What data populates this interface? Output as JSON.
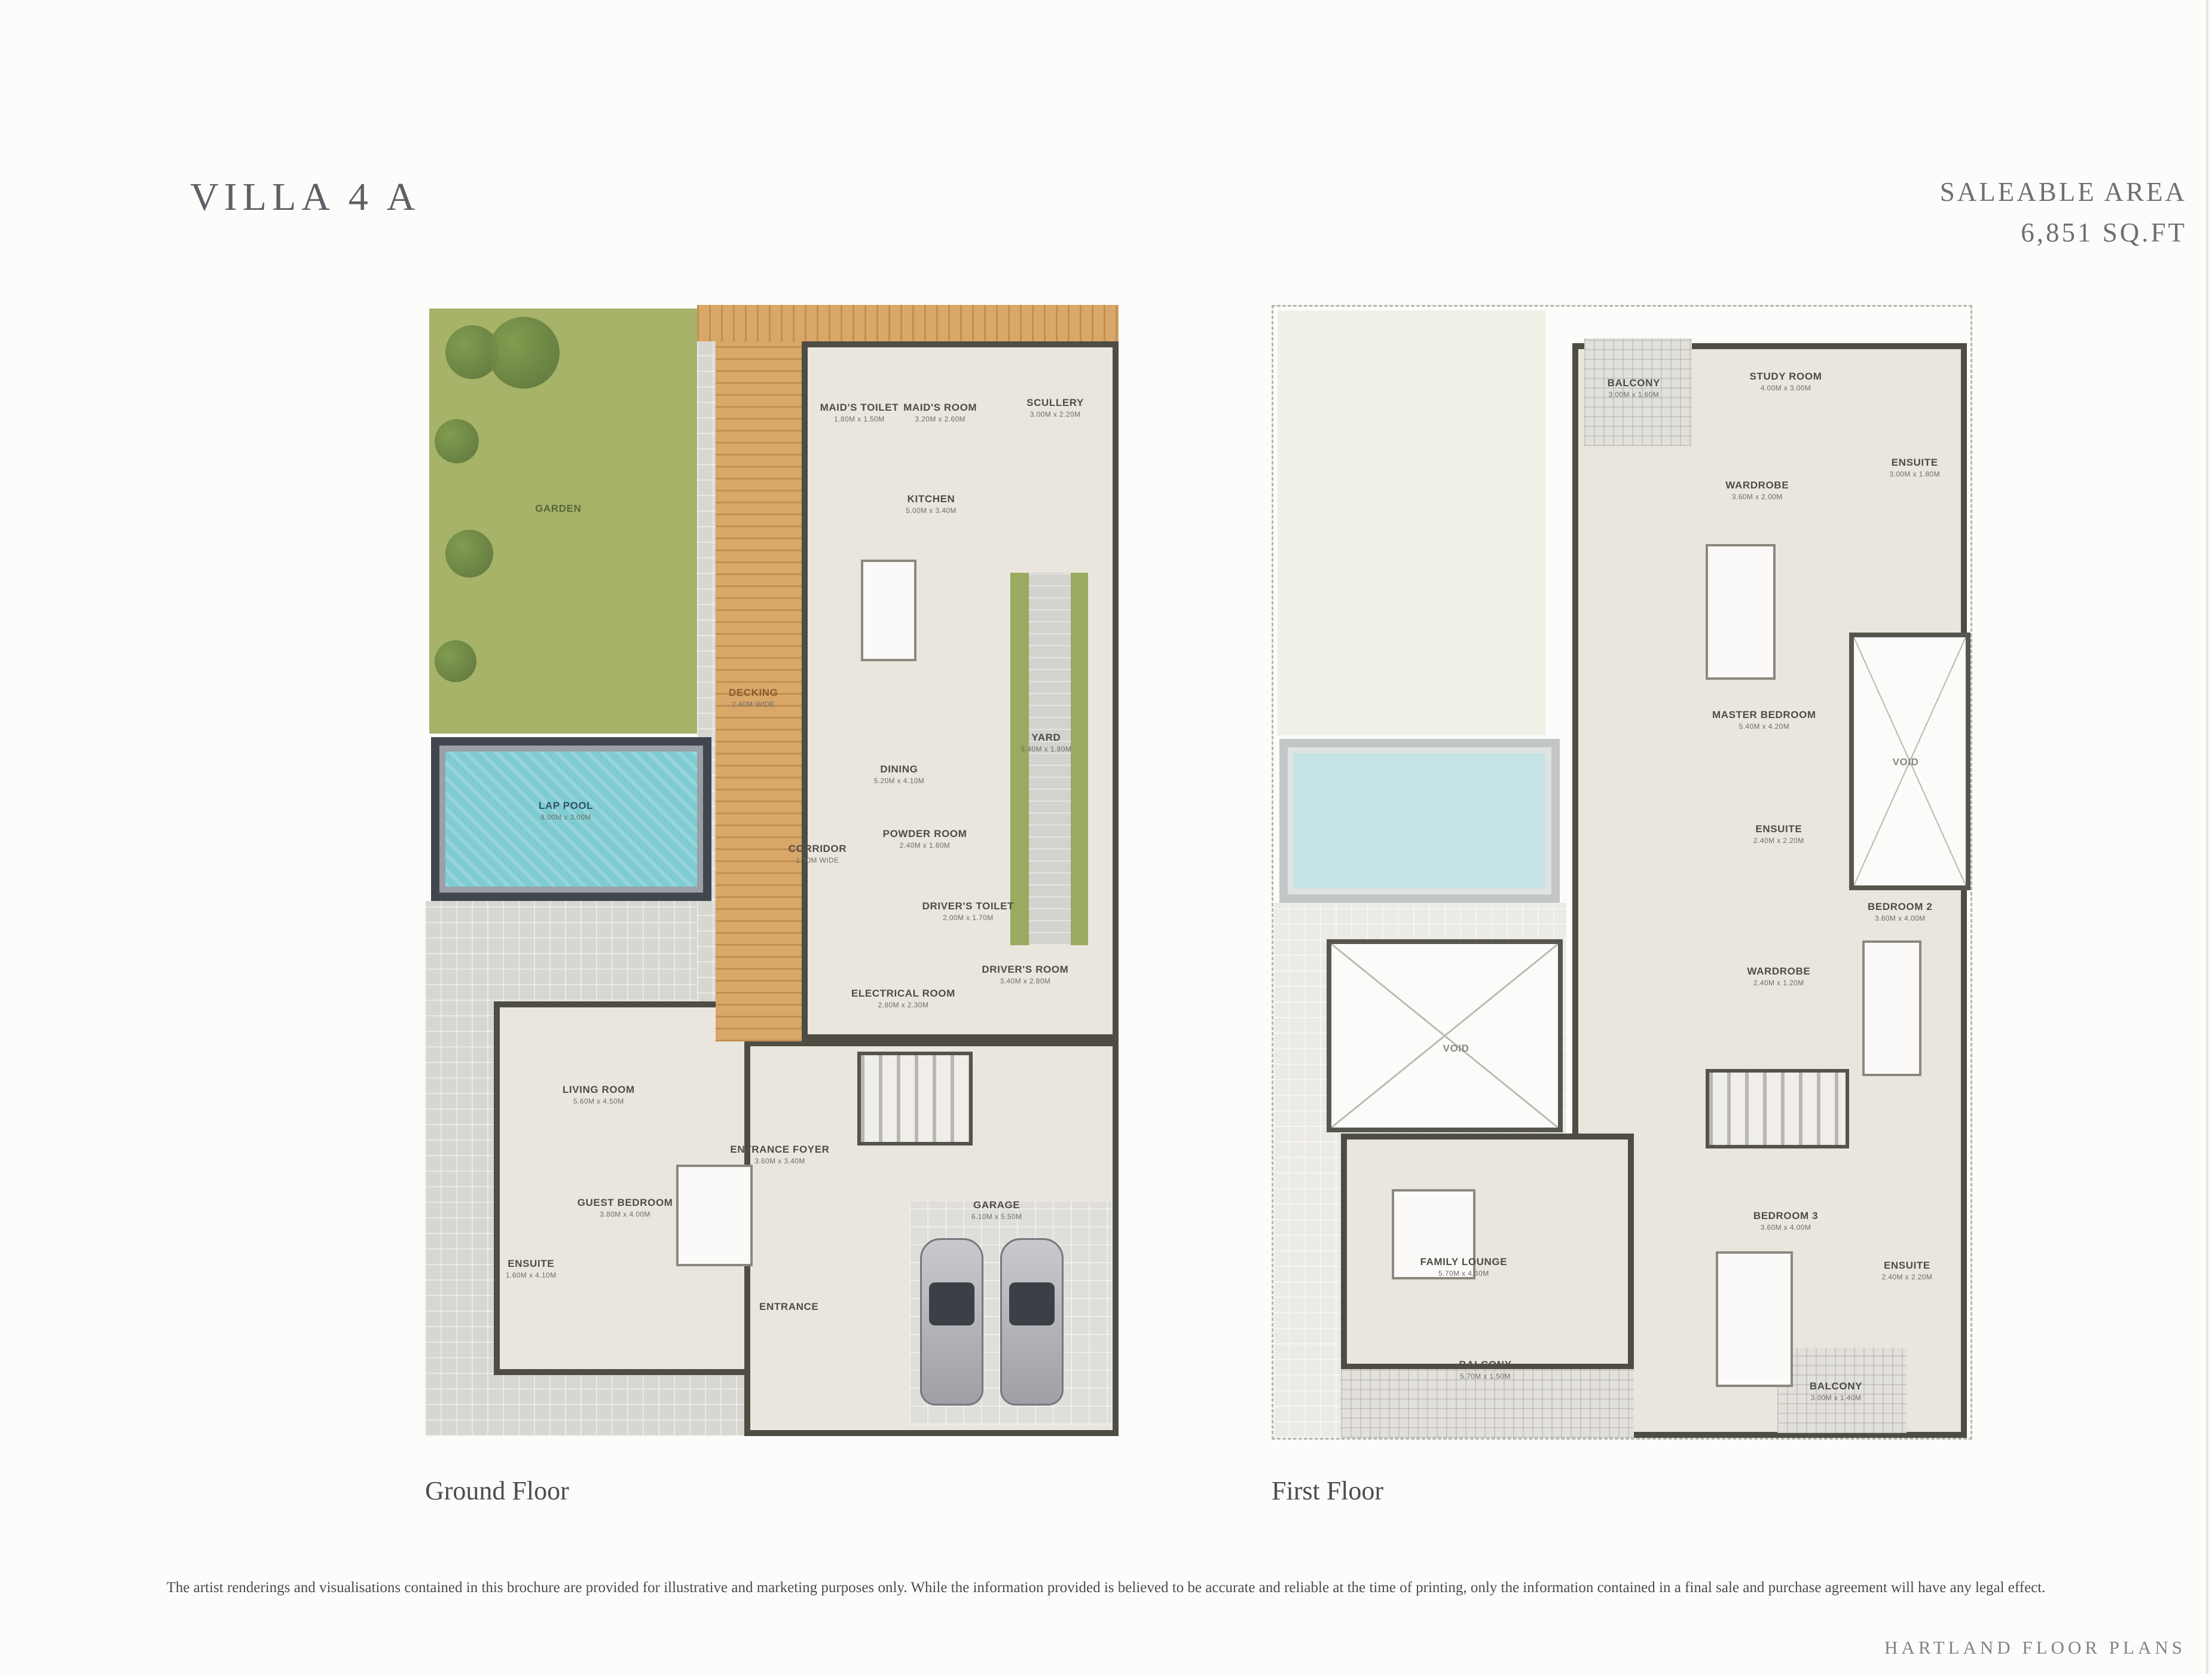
{
  "page": {
    "title": "VILLA 4 A",
    "saleable_area_label": "SALEABLE AREA",
    "saleable_area_value": "6,851 SQ.FT",
    "disclaimer": "The artist renderings and visualisations contained in this brochure are provided for illustrative and marketing purposes only. While the information provided is believed to be accurate and reliable at the time of printing, only the information contained in a final sale and purchase agreement will have any legal effect.",
    "footer": "HARTLAND FLOOR PLANS"
  },
  "colors": {
    "garden": "#a7b368",
    "pool_water": "#7fccd2",
    "decking": "#d9a768",
    "paving": "#d7d6d1",
    "walls": "#4e4d44",
    "room_fill": "#eae6de",
    "heading_text": "#5f5f66"
  },
  "floors": [
    {
      "id": "ground-floor",
      "caption": "Ground Floor",
      "rooms": [
        {
          "label": "GARDEN",
          "dims": "",
          "x": 19.1,
          "y": 18.0,
          "tone": "garden"
        },
        {
          "label": "DECKING",
          "dims": "2.40M WIDE",
          "x": 47.1,
          "y": 34.7,
          "tone": "deck"
        },
        {
          "label": "LAP POOL",
          "dims": "8.00M x 3.00M",
          "x": 20.2,
          "y": 44.7,
          "tone": "pool"
        },
        {
          "label": "MAID'S TOILET",
          "dims": "1.80M x 1.50M",
          "x": 62.3,
          "y": 9.5
        },
        {
          "label": "MAID'S ROOM",
          "dims": "3.20M x 2.60M",
          "x": 73.9,
          "y": 9.5
        },
        {
          "label": "SCULLERY",
          "dims": "3.00M x 2.20M",
          "x": 90.4,
          "y": 9.1
        },
        {
          "label": "KITCHEN",
          "dims": "5.00M x 3.40M",
          "x": 72.6,
          "y": 17.6
        },
        {
          "label": "DINING",
          "dims": "5.20M x 4.10M",
          "x": 68.0,
          "y": 41.5
        },
        {
          "label": "YARD",
          "dims": "5.40M x 1.80M",
          "x": 89.1,
          "y": 38.7
        },
        {
          "label": "CORRIDOR",
          "dims": "1.70M WIDE",
          "x": 56.3,
          "y": 48.5
        },
        {
          "label": "POWDER ROOM",
          "dims": "2.40M x 1.60M",
          "x": 71.7,
          "y": 47.2
        },
        {
          "label": "DRIVER'S TOILET",
          "dims": "2.00M x 1.70M",
          "x": 77.9,
          "y": 53.6
        },
        {
          "label": "ELECTRICAL ROOM",
          "dims": "2.80M x 2.30M",
          "x": 68.6,
          "y": 61.3
        },
        {
          "label": "DRIVER'S ROOM",
          "dims": "3.40M x 2.80M",
          "x": 86.1,
          "y": 59.2
        },
        {
          "label": "LIVING ROOM",
          "dims": "5.60M x 4.50M",
          "x": 24.9,
          "y": 69.8
        },
        {
          "label": "ENTRANCE FOYER",
          "dims": "3.60M x 3.40M",
          "x": 50.9,
          "y": 75.1
        },
        {
          "label": "GUEST BEDROOM",
          "dims": "3.80M x 4.00M",
          "x": 28.7,
          "y": 79.8
        },
        {
          "label": "ENSUITE",
          "dims": "1.60M x 4.10M",
          "x": 15.2,
          "y": 85.2
        },
        {
          "label": "ENTRANCE",
          "dims": "",
          "x": 52.2,
          "y": 88.6
        },
        {
          "label": "GARAGE",
          "dims": "6.10M x 5.50M",
          "x": 82.0,
          "y": 80.0
        }
      ]
    },
    {
      "id": "first-floor",
      "caption": "First Floor",
      "rooms": [
        {
          "label": "BALCONY",
          "dims": "3.00M x 1.60M",
          "x": 51.7,
          "y": 7.2
        },
        {
          "label": "STUDY ROOM",
          "dims": "4.00M x 3.00M",
          "x": 73.5,
          "y": 6.6
        },
        {
          "label": "ENSUITE",
          "dims": "3.00M x 1.80M",
          "x": 92.0,
          "y": 14.2
        },
        {
          "label": "WARDROBE",
          "dims": "3.60M x 2.00M",
          "x": 69.4,
          "y": 16.2
        },
        {
          "label": "MASTER BEDROOM",
          "dims": "5.40M x 4.20M",
          "x": 70.4,
          "y": 36.5
        },
        {
          "label": "VOID",
          "dims": "",
          "x": 90.7,
          "y": 40.3,
          "tone": "ghost"
        },
        {
          "label": "ENSUITE",
          "dims": "2.40M x 2.20M",
          "x": 72.5,
          "y": 46.6
        },
        {
          "label": "BEDROOM 2",
          "dims": "3.60M x 4.00M",
          "x": 89.9,
          "y": 53.5
        },
        {
          "label": "WARDROBE",
          "dims": "2.40M x 1.20M",
          "x": 72.5,
          "y": 59.2
        },
        {
          "label": "VOID",
          "dims": "",
          "x": 26.2,
          "y": 65.6,
          "tone": "ghost"
        },
        {
          "label": "FAMILY LOUNGE",
          "dims": "5.70M x 4.60M",
          "x": 27.3,
          "y": 84.9
        },
        {
          "label": "BEDROOM 3",
          "dims": "3.60M x 4.00M",
          "x": 73.5,
          "y": 80.8
        },
        {
          "label": "ENSUITE",
          "dims": "2.40M x 2.20M",
          "x": 90.9,
          "y": 85.2
        },
        {
          "label": "BALCONY",
          "dims": "5.70M x 1.50M",
          "x": 30.4,
          "y": 94.0
        },
        {
          "label": "BALCONY",
          "dims": "3.00M x 1.40M",
          "x": 80.7,
          "y": 95.9
        }
      ]
    }
  ]
}
